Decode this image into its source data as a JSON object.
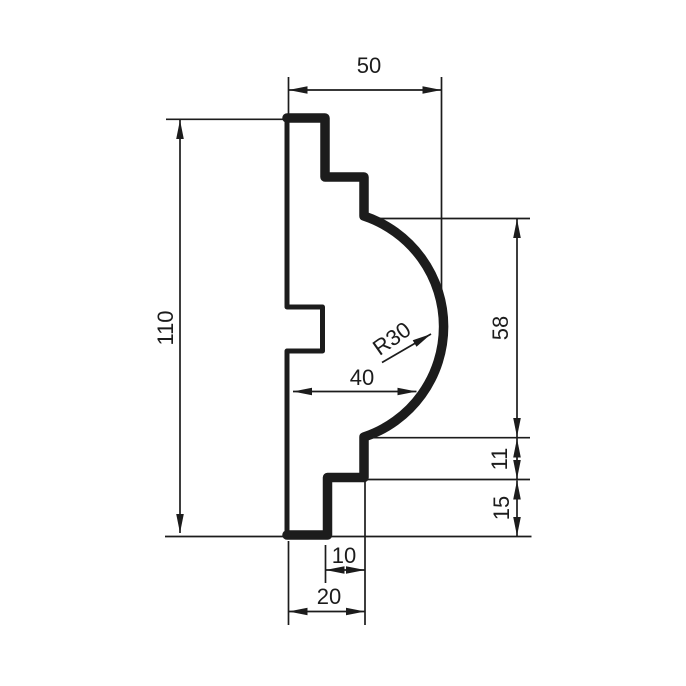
{
  "drawing": {
    "kind": "moulding-profile-section",
    "background_color": "#ffffff",
    "ink_color": "#1c1c1c"
  },
  "dims": {
    "top_width": "50",
    "total_height": "110",
    "arc_height": "58",
    "mid_step_height": "11",
    "bottom_step_height": "15",
    "mid_width": "40",
    "arc_radius": "R30",
    "bottom_inner_width": "10",
    "bottom_width": "20"
  }
}
